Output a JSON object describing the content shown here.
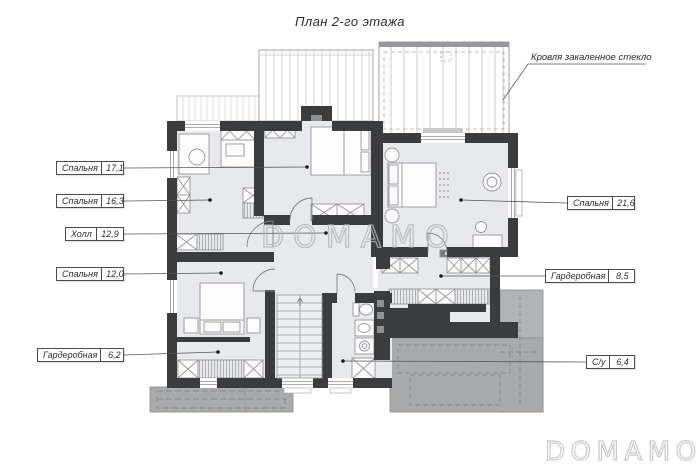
{
  "title": "План 2-го этажа",
  "annotation": {
    "roof_glass": "Кровля закаленное стекло"
  },
  "watermark": {
    "center": "DOMAMO",
    "corner": "DOMAMO"
  },
  "rooms": [
    {
      "name": "Спальня",
      "area": "17,1"
    },
    {
      "name": "Спальня",
      "area": "16,3"
    },
    {
      "name": "Холл",
      "area": "12,9"
    },
    {
      "name": "Спальня",
      "area": "12,0"
    },
    {
      "name": "Гардеробная",
      "area": "6,2"
    },
    {
      "name": "Спальня",
      "area": "21,6"
    },
    {
      "name": "Гардеробная",
      "area": "8,5"
    },
    {
      "name": "С/у",
      "area": "6,4"
    }
  ],
  "colors": {
    "background": "#ffffff",
    "wall": "#3b3c3e",
    "floor": "#e8e9ec",
    "terrace_roof": "#a8aaac",
    "glass_roof_band": "#96989b",
    "label_border": "#4b4b4b",
    "leader_line": "#55565a",
    "watermark": "#b5b7ba"
  }
}
